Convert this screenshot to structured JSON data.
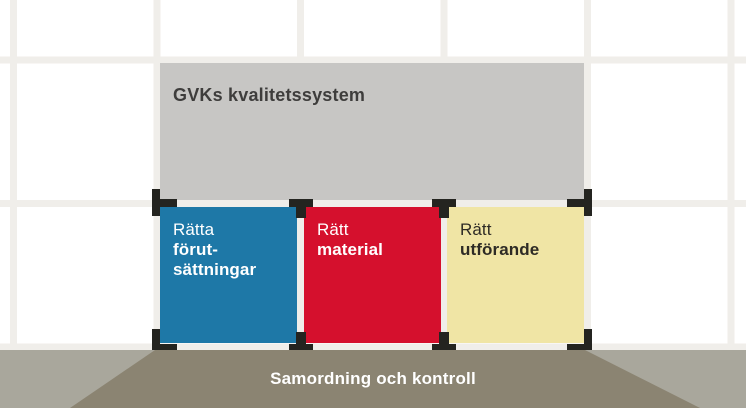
{
  "diagram": {
    "title_box": {
      "label": "GVKs kvalitetssystem",
      "bg_color": "#c7c6c4",
      "text_color": "#3e3d3c"
    },
    "pillars": [
      {
        "name": "ratta-forutsattningar",
        "lines": [
          "Rätta",
          "förut-",
          "sättningar"
        ],
        "bg_color": "#1e78a7",
        "text_color": "#ffffff"
      },
      {
        "name": "ratt-material",
        "lines": [
          "Rätt",
          "material"
        ],
        "bg_color": "#d5102d",
        "text_color": "#ffffff"
      },
      {
        "name": "ratt-utforande",
        "lines": [
          "Rätt",
          "utförande"
        ],
        "bg_color": "#f0e5a5",
        "text_color": "#2e2b25"
      }
    ],
    "floor": {
      "label": "Samordning och kontroll",
      "trapezoid_color": "#8b8472",
      "band_color": "#a9a79c",
      "text_color": "#ffffff"
    },
    "wall": {
      "tile_color": "#ffffff",
      "grout_color": "#f0eeea"
    },
    "spacer_color": "#242420"
  }
}
